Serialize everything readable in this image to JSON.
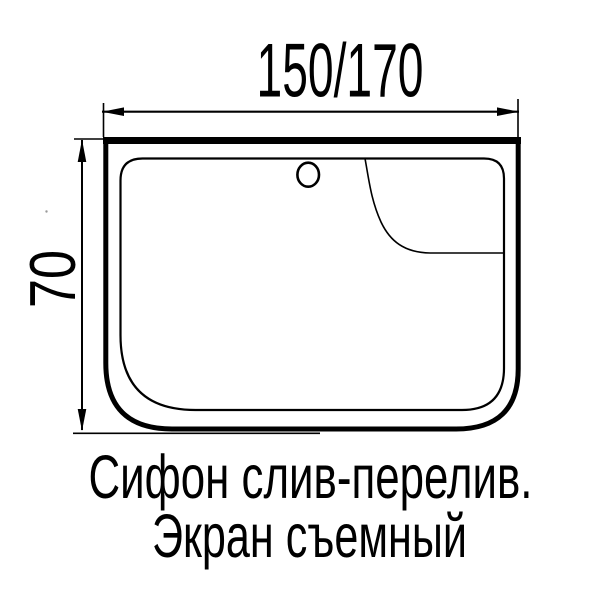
{
  "page": {
    "background_color": "#ffffff",
    "ink_color": "#000000"
  },
  "diagram": {
    "type": "bathtub-top-view-technical-drawing",
    "top_dimension_label": "150/170",
    "left_dimension_label": "70",
    "caption_line1": "Сифон слив-перелив.",
    "caption_line2": "Экран съемный"
  }
}
